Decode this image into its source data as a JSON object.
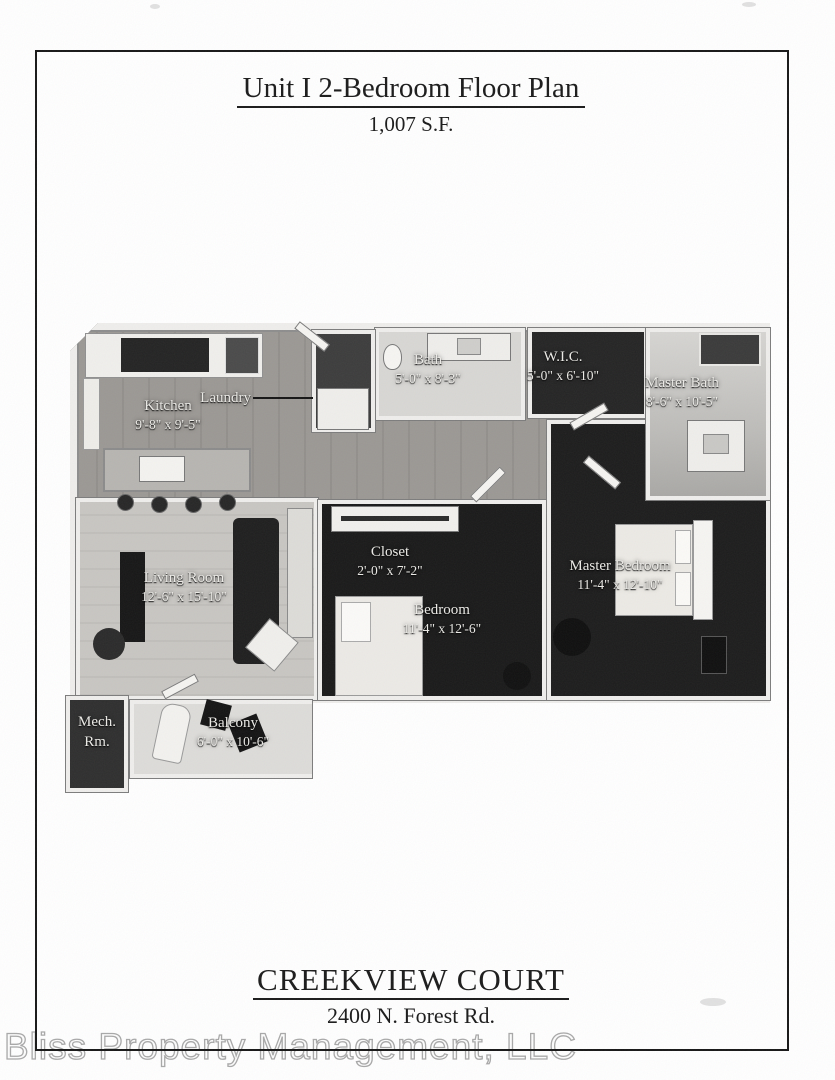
{
  "page": {
    "title": "Unit I 2-Bedroom Floor Plan",
    "subtitle": "1,007 S.F.",
    "property_name": "CREEKVIEW COURT",
    "address": "2400 N. Forest Rd.",
    "watermark": "Bliss Property Management, LLC"
  },
  "rooms": {
    "kitchen": {
      "name": "Kitchen",
      "dims": "9'-8\" x 9'-5\""
    },
    "laundry": {
      "name": "Laundry"
    },
    "bath": {
      "name": "Bath",
      "dims": "5'-0\" x 8'-3\""
    },
    "wic": {
      "name": "W.I.C.",
      "dims": "5'-0\" x 6'-10\""
    },
    "master_bath": {
      "name": "Master Bath",
      "dims": "8'-6\" x 10'-5\""
    },
    "living_room": {
      "name": "Living Room",
      "dims": "12'-6\" x 15'-10\""
    },
    "closet": {
      "name": "Closet",
      "dims": "2'-0\" x 7'-2\""
    },
    "bedroom": {
      "name": "Bedroom",
      "dims": "11'-4\" x 12'-6\""
    },
    "master_bedroom": {
      "name": "Master Bedroom",
      "dims": "11'-4\" x 12'-10\""
    },
    "mech_room": {
      "name": "Mech. Rm."
    },
    "balcony": {
      "name": "Balcony",
      "dims": "6'-0\" x 10'-6\""
    }
  },
  "colors": {
    "wall": "#efeeec",
    "floor_wood": "#9b9894",
    "floor_light": "#c8c6c2",
    "floor_dark": "#1c1c1c",
    "ink": "#161616"
  }
}
